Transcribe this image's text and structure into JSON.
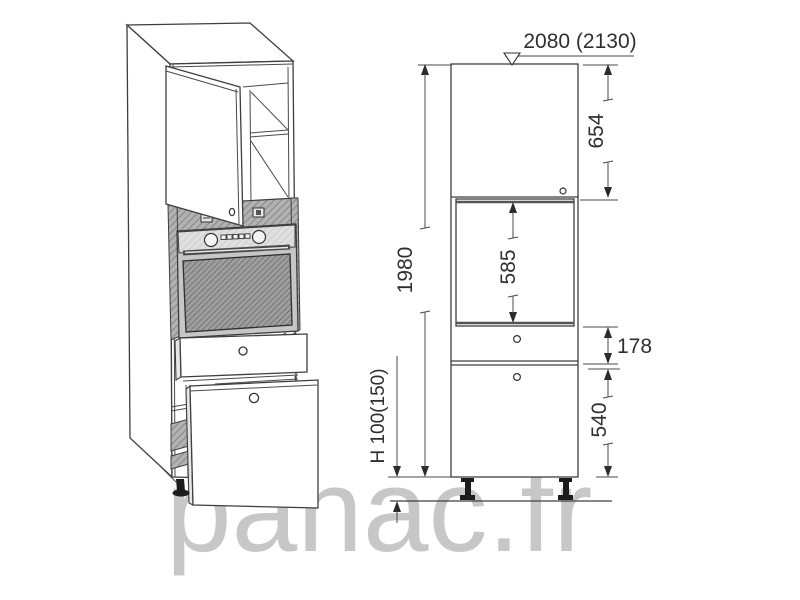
{
  "watermark": {
    "text": "panac.fr",
    "color": "#c7c7c7"
  },
  "elevation": {
    "dims": {
      "width": "2080 (2130)",
      "total_height": "1980",
      "top_door_height": "654",
      "oven_opening_height": "585",
      "drawer_height": "178",
      "bottom_drawer_height": "540",
      "plinth_height": "H 100(150)"
    }
  },
  "colors": {
    "line": "#3e3e3e",
    "hatch_band": "#b2b2b2",
    "hatch_glass": "#9e9e9e",
    "panel_light": "#e0e0e0",
    "watermark": "#c7c7c7"
  }
}
